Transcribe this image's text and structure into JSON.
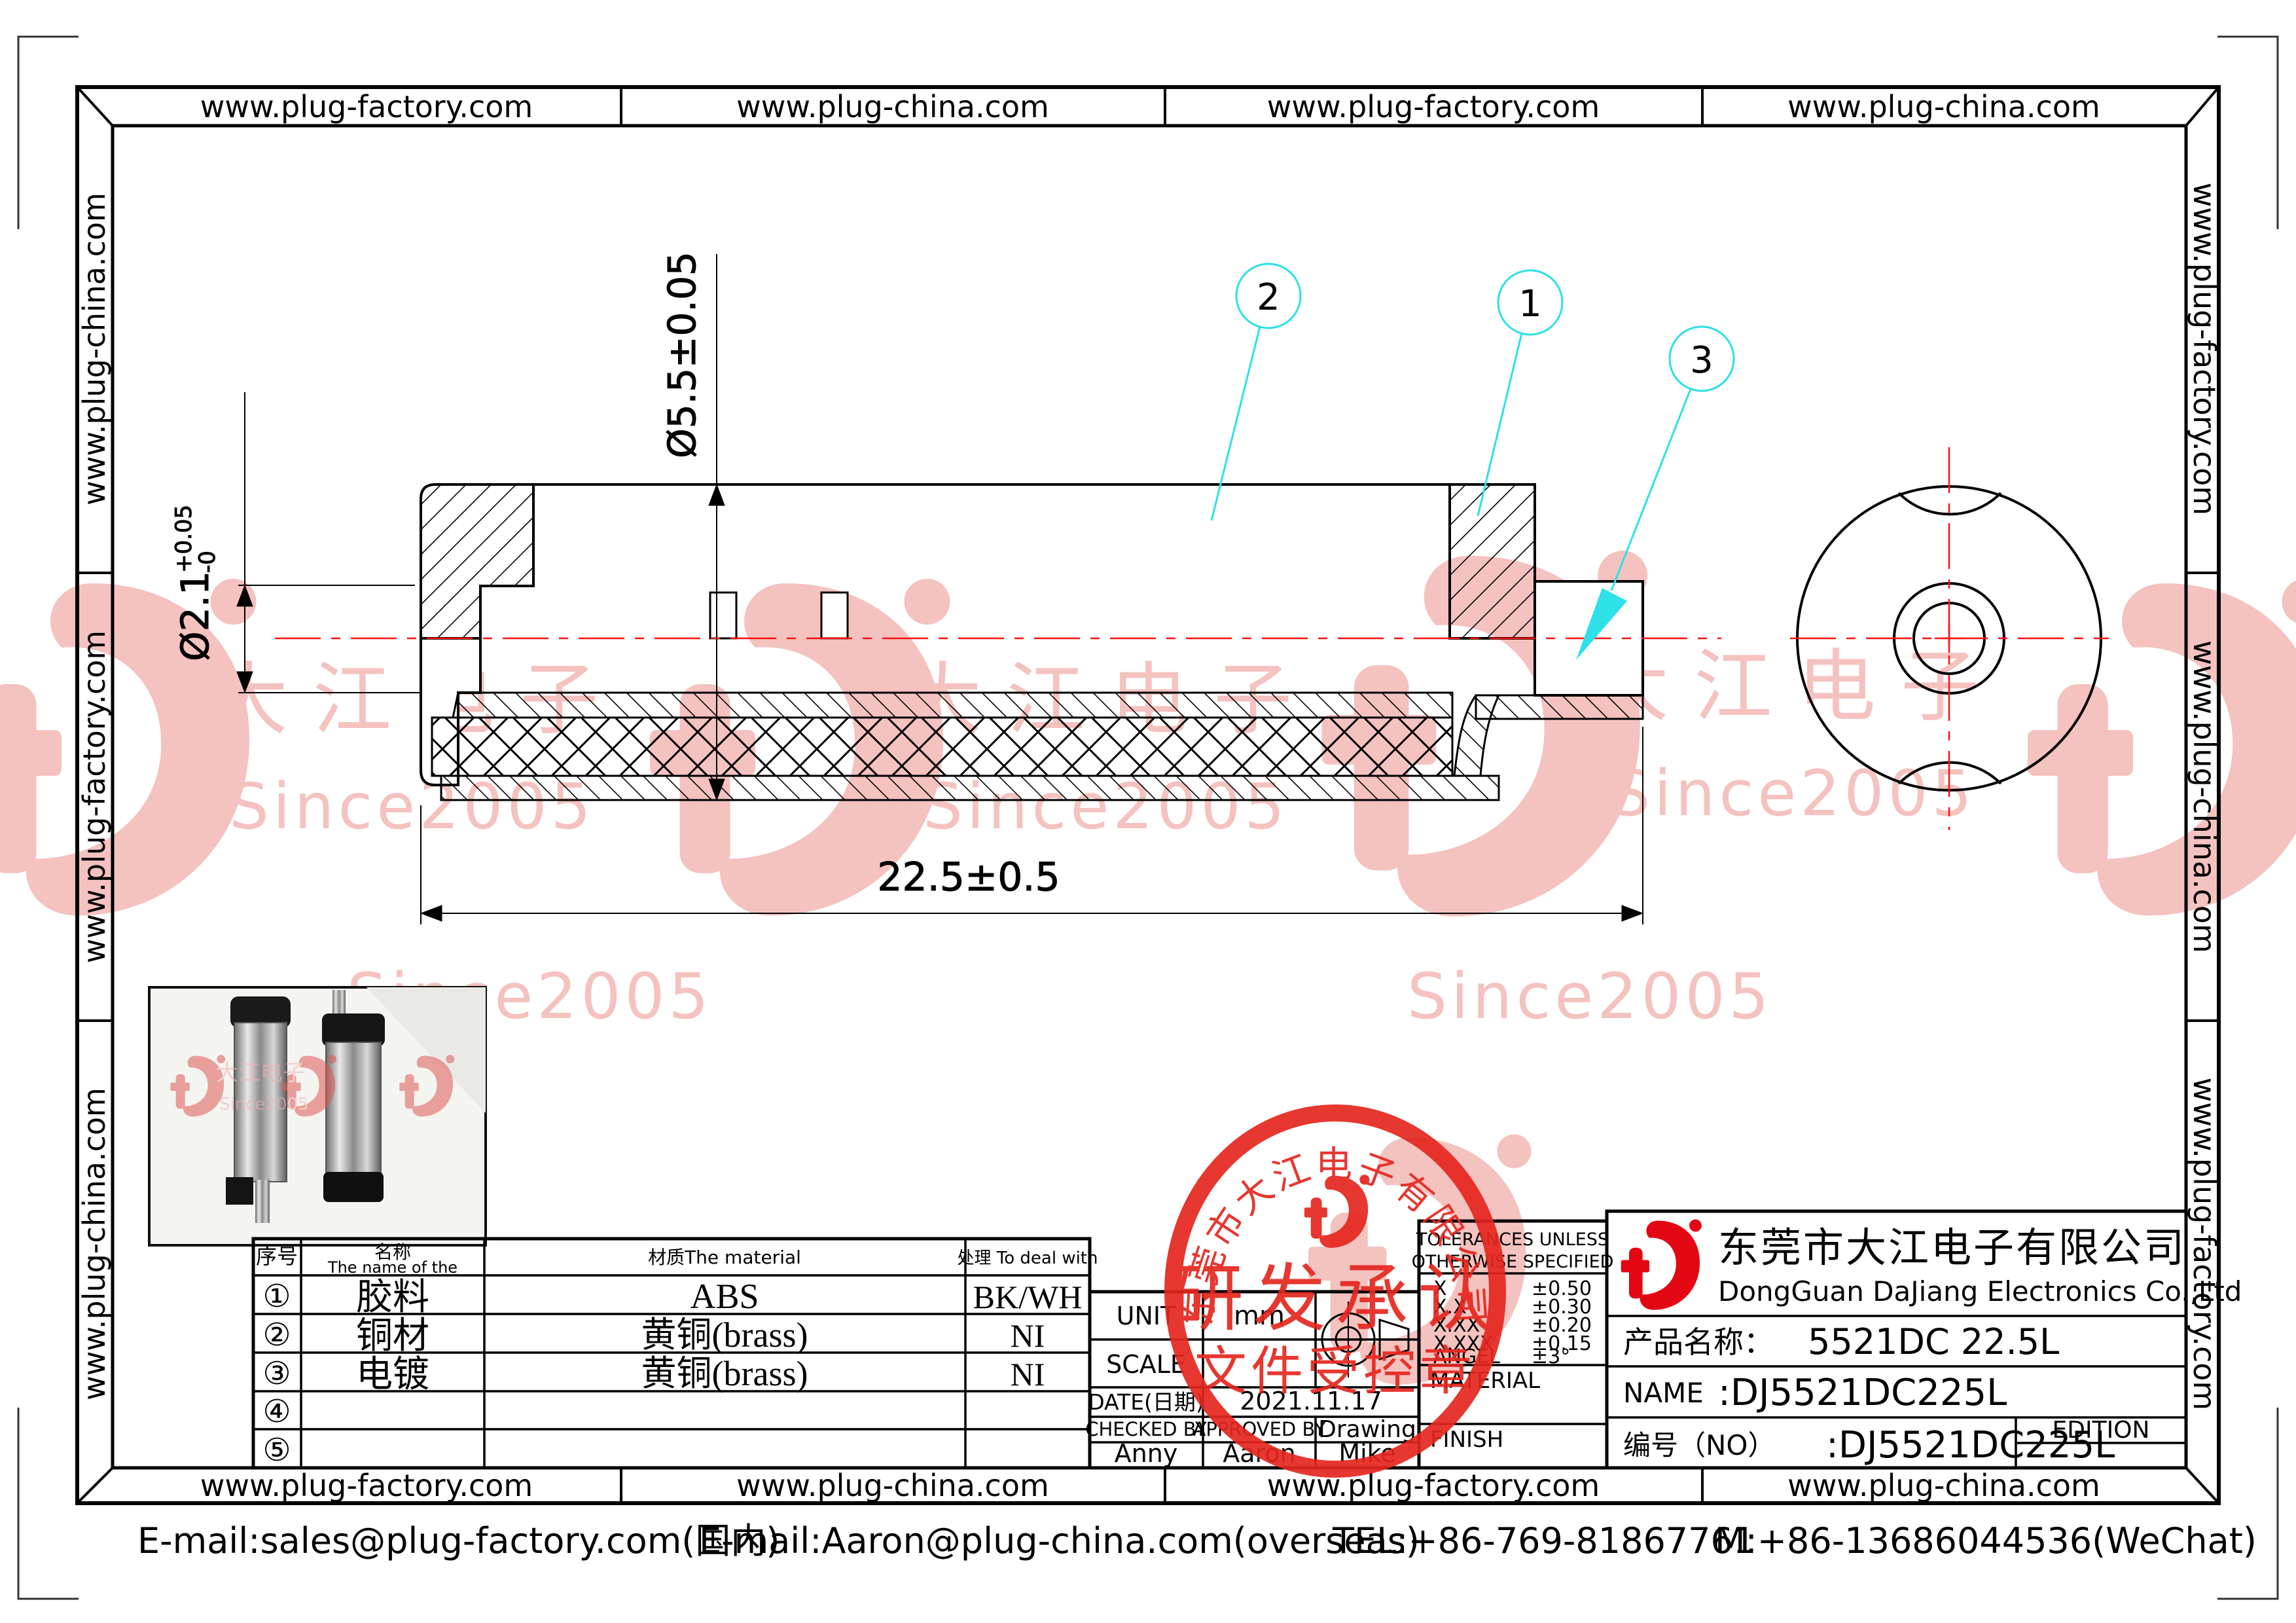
{
  "border": {
    "top_cells": [
      "www.plug-factory.com",
      "www.plug-china.com",
      "www.plug-factory.com",
      "www.plug-china.com"
    ],
    "bottom_cells": [
      "www.plug-factory.com",
      "www.plug-china.com",
      "www.plug-factory.com",
      "www.plug-china.com"
    ],
    "left_cells": [
      "www.plug-china.com",
      "www.plug-factory.com",
      "www.plug-china.com"
    ],
    "right_cells": [
      "www.plug-factory.com",
      "www.plug-china.com",
      "www.plug-factory.com"
    ]
  },
  "drawing": {
    "dim_outer_dia": "Ø5.5±0.05",
    "dim_bore_dia": "Ø2.1",
    "dim_bore_tol_plus": "+0.05",
    "dim_bore_tol_minus": "-0",
    "dim_length": "22.5±0.5",
    "callout_1": "1",
    "callout_2": "2",
    "callout_3": "3"
  },
  "watermark": {
    "brand": "大江电子",
    "since": "Since2005"
  },
  "parts_table": {
    "col_no": "序号",
    "col_name_cn": "名称",
    "col_name_en": "The name of the",
    "col_material": "材质The material",
    "col_treat": "处理 To deal with",
    "rows": [
      {
        "no": "①",
        "name": "胶料",
        "material": "ABS",
        "treat": "BK/WH"
      },
      {
        "no": "②",
        "name": "铜材",
        "material": "黄铜(brass)",
        "treat": "NI"
      },
      {
        "no": "③",
        "name": "电镀",
        "material": "黄铜(brass)",
        "treat": "NI"
      },
      {
        "no": "④",
        "name": "",
        "material": "",
        "treat": ""
      },
      {
        "no": "⑤",
        "name": "",
        "material": "",
        "treat": ""
      }
    ]
  },
  "info_table": {
    "unit_label": "UNIT",
    "unit_value": "mm",
    "scale_label": "SCALE",
    "scale_value": "",
    "date_label": "DATE(日期)",
    "date_value": "2021.11.17",
    "checked_label": "CHECKED BY",
    "approved_label": "APPROVED BY",
    "drawing_label": "Drawing",
    "checked_value": "Anny",
    "approved_value": "Aaron",
    "drawing_value": "Mike"
  },
  "tolerances": {
    "title_line1": "TOLERANCES UNLESS",
    "title_line2": "OTHERWISE SPECIFIED",
    "rows": [
      {
        "label": "X",
        "value": "±0.50"
      },
      {
        "label": "X.X",
        "value": "±0.30"
      },
      {
        "label": "X.XX",
        "value": "±0.20"
      },
      {
        "label": "X.XXX",
        "value": "±0.15"
      },
      {
        "label": "ANGEL",
        "value": "±3°"
      }
    ],
    "material_label": "MATERIAL",
    "finish_label": "FINISH"
  },
  "company": {
    "name_cn": "东莞市大江电子有限公司",
    "name_en": "DongGuan DaJiang Electronics Co.,Ltd",
    "product_label": "产品名称：",
    "product_value": "5521DC 22.5L",
    "name_label": "NAME",
    "name_value": ":DJ5521DC225L",
    "no_label": "编号（NO）",
    "no_value": ":DJ5521DC225L",
    "edition_label": "EDITION"
  },
  "stamp": {
    "arc_text": "东莞市大江电子有限公司",
    "line1": "研发承认",
    "line2": "文件受控章"
  },
  "footer": {
    "item1": "E-mail:sales@plug-factory.com(国内)",
    "item2": "E-mail:Aaron@plug-china.com(overseas)",
    "item3": "TEL:+86-769-81867761",
    "item4": "M:+86-13686044536(WeChat)"
  }
}
